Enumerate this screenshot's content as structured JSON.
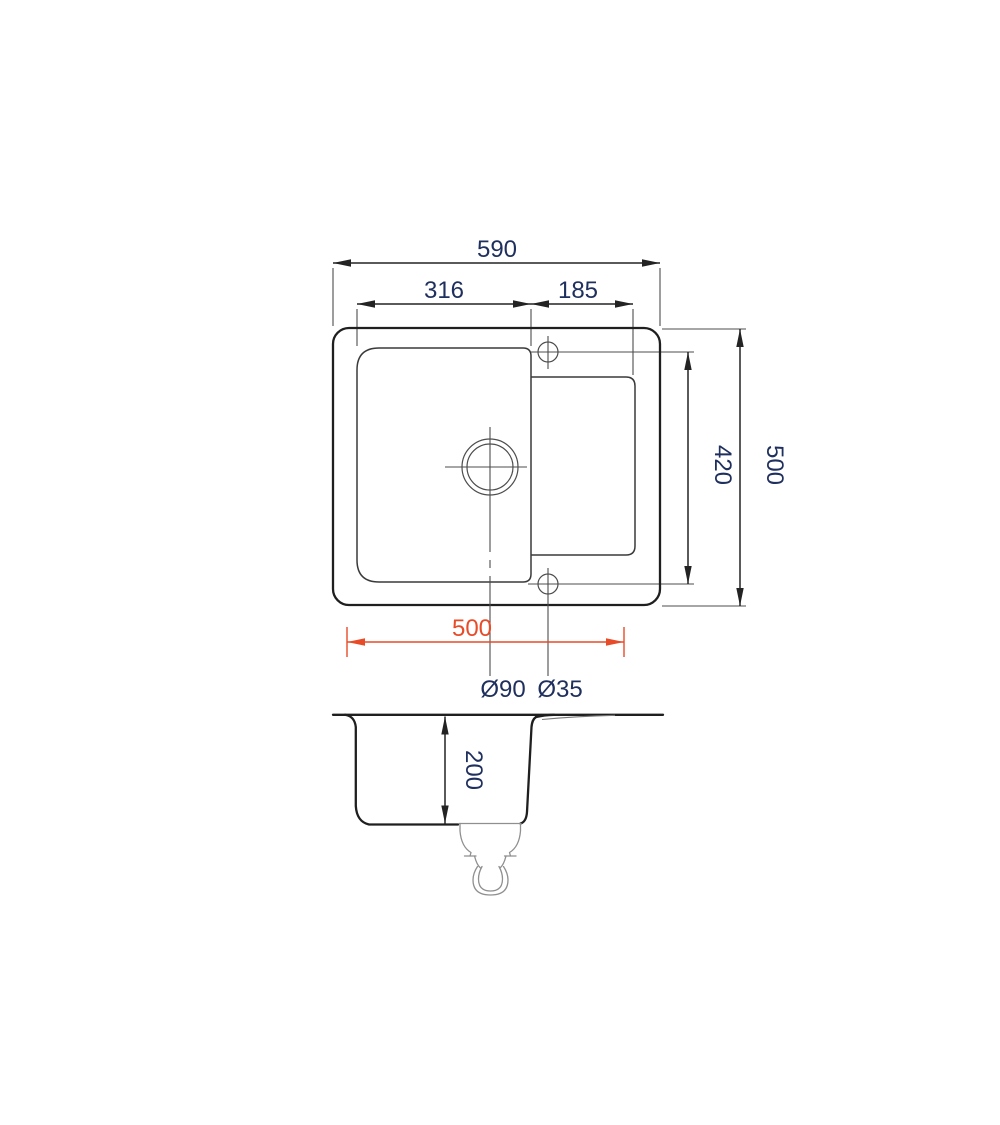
{
  "colors": {
    "background": "#ffffff",
    "line": "#1f1f1f",
    "thin_line": "#4d4d4d",
    "dim_text": "#20305e",
    "accent": "#e84b28"
  },
  "top_view": {
    "overall_width_label": "590",
    "bowl_width_label": "316",
    "drainer_width_label": "185",
    "overall_depth_label": "500",
    "holes_span_label": "420",
    "cutout_width_label": "500",
    "drain_hole_label": "Ø90",
    "tap_hole_label": "Ø35"
  },
  "section_view": {
    "bowl_depth_label": "200"
  }
}
